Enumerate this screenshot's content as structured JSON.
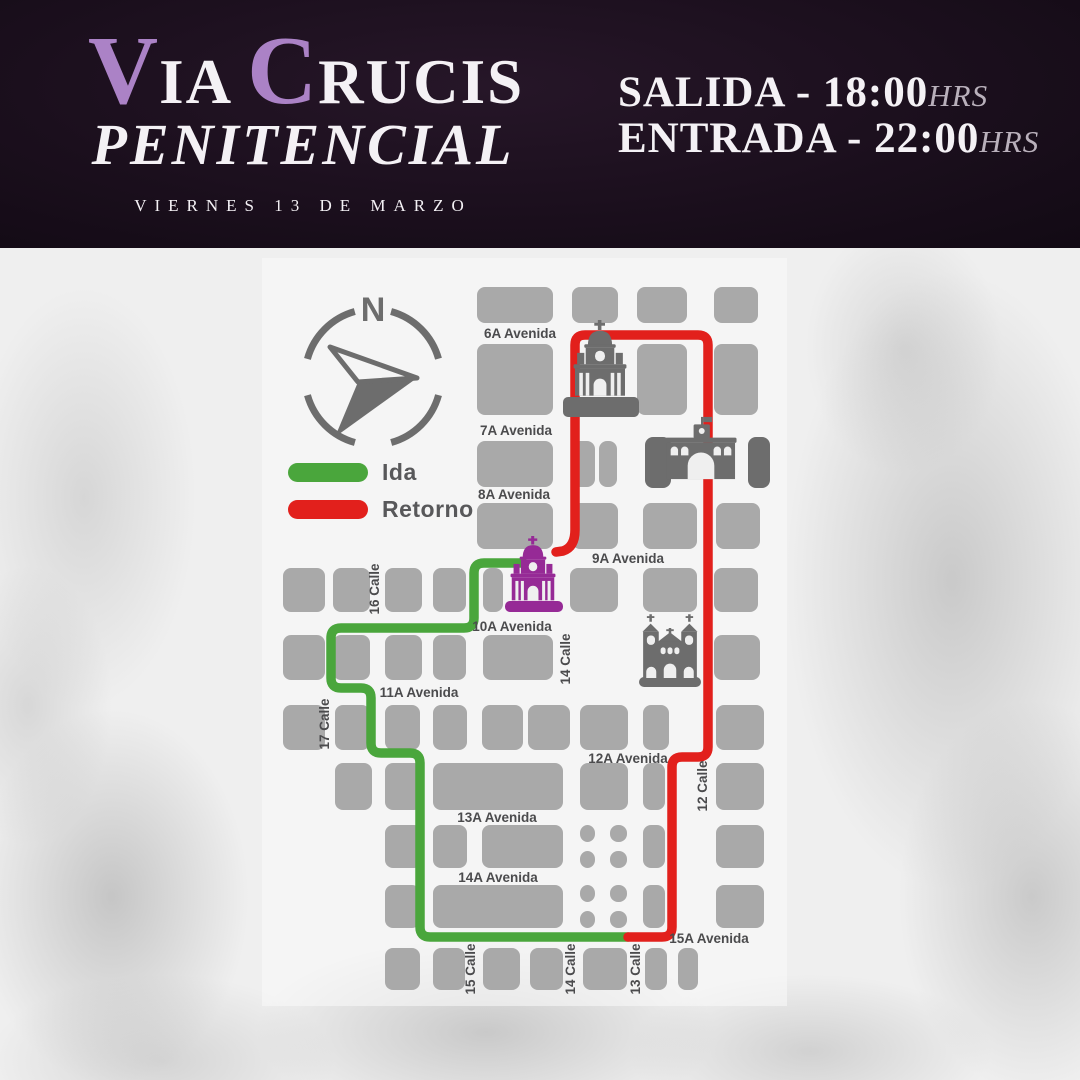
{
  "header": {
    "title": {
      "v": "V",
      "ia": "IA",
      "c": "C",
      "rucis": "RUCIS",
      "line2": "PENITENCIAL"
    },
    "date": "VIERNES 13 DE MARZO",
    "times": [
      {
        "label": "SALIDA - 18:00",
        "suffix": "HRS"
      },
      {
        "label": "ENTRADA - 22:00",
        "suffix": "HRS"
      }
    ],
    "accent_color": "#ab82c6"
  },
  "compass": {
    "label": "N",
    "cx": 373,
    "cy": 377,
    "r": 68
  },
  "legend": {
    "items": [
      {
        "label": "Ida",
        "color": "#4aa63c"
      },
      {
        "label": "Retorno",
        "color": "#e2201c"
      }
    ]
  },
  "map": {
    "colors": {
      "block": "#a9a9a9",
      "block_dark": "#6d6d6d",
      "bg_cut": "#efefef",
      "street_text": "#4b4b4d",
      "church_gray": "#6d6d6d",
      "church_purple": "#962a96",
      "ida": "#4aa63c",
      "retorno": "#e2201c"
    },
    "streets": [
      {
        "label": "6A Avenida",
        "x": 520,
        "y": 338,
        "rot": 0
      },
      {
        "label": "7A Avenida",
        "x": 516,
        "y": 435,
        "rot": 0
      },
      {
        "label": "8A Avenida",
        "x": 514,
        "y": 499,
        "rot": 0
      },
      {
        "label": "9A Avenida",
        "x": 628,
        "y": 563,
        "rot": 0
      },
      {
        "label": "10A Avenida",
        "x": 512,
        "y": 631,
        "rot": 0
      },
      {
        "label": "11A Avenida",
        "x": 419,
        "y": 697,
        "rot": 0
      },
      {
        "label": "12A Avenida",
        "x": 628,
        "y": 763,
        "rot": 0
      },
      {
        "label": "13A Avenida",
        "x": 497,
        "y": 822,
        "rot": 0
      },
      {
        "label": "14A Avenida",
        "x": 498,
        "y": 882,
        "rot": 0
      },
      {
        "label": "15A Avenida",
        "x": 709,
        "y": 943,
        "rot": 0
      },
      {
        "label": "16 Calle",
        "x": 379,
        "y": 589,
        "rot": -90
      },
      {
        "label": "17 Calle",
        "x": 329,
        "y": 724,
        "rot": -90
      },
      {
        "label": "14 Calle",
        "x": 570,
        "y": 659,
        "rot": -90
      },
      {
        "label": "12 Calle",
        "x": 707,
        "y": 786,
        "rot": -90
      },
      {
        "label": "15 Calle",
        "x": 475,
        "y": 969,
        "rot": -90
      },
      {
        "label": "14 Calle",
        "x": 575,
        "y": 969,
        "rot": -90
      },
      {
        "label": "13 Calle",
        "x": 640,
        "y": 969,
        "rot": -90
      }
    ],
    "blocks": [
      [
        477,
        287,
        76,
        36,
        "m"
      ],
      [
        572,
        287,
        46,
        36,
        "m"
      ],
      [
        637,
        287,
        50,
        36,
        "m"
      ],
      [
        714,
        287,
        44,
        36,
        "m"
      ],
      [
        477,
        344,
        76,
        71,
        "m"
      ],
      [
        637,
        344,
        50,
        71,
        "m"
      ],
      [
        714,
        344,
        44,
        71,
        "m"
      ],
      [
        477,
        441,
        76,
        46,
        "m"
      ],
      [
        572,
        441,
        23,
        46,
        "m"
      ],
      [
        599,
        441,
        18,
        46,
        "m"
      ],
      [
        645,
        437,
        26,
        51,
        "d"
      ],
      [
        748,
        437,
        22,
        51,
        "d"
      ],
      [
        477,
        503,
        76,
        46,
        "m"
      ],
      [
        572,
        503,
        46,
        46,
        "m"
      ],
      [
        643,
        503,
        54,
        46,
        "m"
      ],
      [
        716,
        503,
        44,
        46,
        "m"
      ],
      [
        283,
        568,
        42,
        44,
        "m"
      ],
      [
        333,
        568,
        37,
        44,
        "m"
      ],
      [
        385,
        568,
        37,
        44,
        "m"
      ],
      [
        433,
        568,
        33,
        44,
        "m"
      ],
      [
        483,
        568,
        20,
        44,
        "m"
      ],
      [
        570,
        568,
        48,
        44,
        "m"
      ],
      [
        643,
        568,
        54,
        44,
        "m"
      ],
      [
        714,
        568,
        44,
        44,
        "m"
      ],
      [
        283,
        635,
        42,
        45,
        "m"
      ],
      [
        333,
        635,
        37,
        45,
        "m"
      ],
      [
        385,
        635,
        37,
        45,
        "m"
      ],
      [
        433,
        635,
        33,
        45,
        "m"
      ],
      [
        483,
        635,
        70,
        45,
        "m"
      ],
      [
        714,
        635,
        46,
        45,
        "m"
      ],
      [
        283,
        705,
        42,
        45,
        "m"
      ],
      [
        335,
        705,
        35,
        45,
        "m"
      ],
      [
        385,
        705,
        35,
        45,
        "m"
      ],
      [
        433,
        705,
        34,
        45,
        "m"
      ],
      [
        482,
        705,
        41,
        45,
        "m"
      ],
      [
        528,
        705,
        42,
        45,
        "m"
      ],
      [
        580,
        705,
        48,
        45,
        "m"
      ],
      [
        643,
        705,
        26,
        45,
        "m"
      ],
      [
        716,
        705,
        48,
        45,
        "m"
      ],
      [
        335,
        763,
        37,
        47,
        "m"
      ],
      [
        385,
        763,
        37,
        47,
        "m"
      ],
      [
        433,
        763,
        130,
        47,
        "m"
      ],
      [
        580,
        763,
        48,
        47,
        "m"
      ],
      [
        643,
        763,
        22,
        47,
        "m"
      ],
      [
        716,
        763,
        48,
        47,
        "m"
      ],
      [
        385,
        825,
        37,
        43,
        "m"
      ],
      [
        433,
        825,
        34,
        43,
        "m"
      ],
      [
        482,
        825,
        81,
        43,
        "m"
      ],
      [
        580,
        825,
        15,
        17,
        "m"
      ],
      [
        610,
        825,
        17,
        17,
        "m"
      ],
      [
        580,
        851,
        15,
        17,
        "m"
      ],
      [
        610,
        851,
        17,
        17,
        "m"
      ],
      [
        643,
        825,
        22,
        43,
        "m"
      ],
      [
        716,
        825,
        48,
        43,
        "m"
      ],
      [
        385,
        885,
        35,
        43,
        "m"
      ],
      [
        433,
        885,
        130,
        43,
        "m"
      ],
      [
        580,
        885,
        15,
        17,
        "m"
      ],
      [
        610,
        885,
        17,
        17,
        "m"
      ],
      [
        580,
        911,
        15,
        17,
        "m"
      ],
      [
        610,
        911,
        17,
        17,
        "m"
      ],
      [
        643,
        885,
        22,
        43,
        "m"
      ],
      [
        716,
        885,
        48,
        43,
        "m"
      ],
      [
        385,
        948,
        35,
        42,
        "m"
      ],
      [
        433,
        948,
        32,
        42,
        "m"
      ],
      [
        483,
        948,
        37,
        42,
        "m"
      ],
      [
        530,
        948,
        33,
        42,
        "m"
      ],
      [
        583,
        948,
        44,
        42,
        "m"
      ],
      [
        645,
        948,
        22,
        42,
        "m"
      ],
      [
        678,
        948,
        20,
        42,
        "m"
      ]
    ],
    "bases": [
      [
        563,
        397,
        76,
        20,
        "#6d6d6d"
      ],
      [
        505,
        601,
        58,
        11,
        "#962a96"
      ],
      [
        639,
        677,
        62,
        10,
        "#6d6d6d"
      ]
    ],
    "churches": [
      {
        "glyph": "church",
        "x": 561,
        "y": 320,
        "w": 78,
        "h": 80,
        "color": "#6d6d6d",
        "name": "church-north-icon"
      },
      {
        "glyph": "arch",
        "x": 664,
        "y": 412,
        "w": 74,
        "h": 72,
        "color": "#6d6d6d",
        "name": "arch-monument-icon"
      },
      {
        "glyph": "church",
        "x": 501,
        "y": 536,
        "w": 64,
        "h": 68,
        "color": "#962a96",
        "name": "church-start-icon"
      },
      {
        "glyph": "church2",
        "x": 637,
        "y": 613,
        "w": 66,
        "h": 65,
        "color": "#6d6d6d",
        "name": "church-east-icon"
      }
    ],
    "routes": {
      "ida": "M 523 563 L 484 563 Q 474 563 474 573 L 474 618 Q 474 628 464 628 L 341 628 Q 331 628 331 638 L 331 678 Q 331 688 341 688 L 361 688 Q 371 688 371 698 L 371 743 Q 371 753 381 753 L 410 753 Q 420 753 420 763 L 420 927 Q 420 937 430 937 L 628 937",
      "retorno": "M 628 937 L 662 937 Q 672 937 672 927 L 672 767 Q 672 757 682 757 L 698 757 Q 708 757 708 747 L 708 345 Q 708 335 698 335 L 585 335 Q 575 335 575 345 L 575 530 Q 575 547 563 551 L 556 552"
    }
  }
}
